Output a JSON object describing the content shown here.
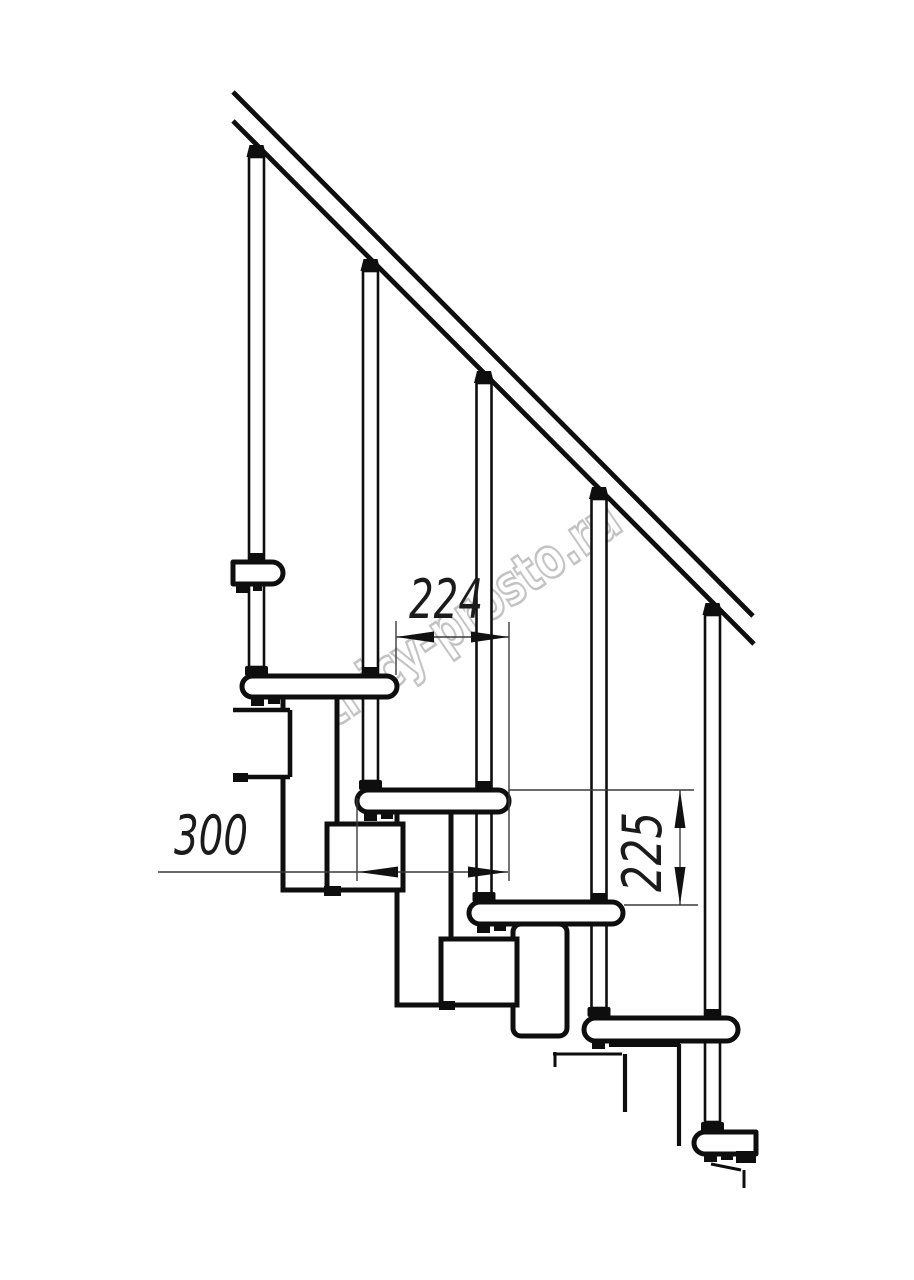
{
  "watermark": {
    "text": "lestnicy-prosto.ru",
    "stroke_color": "#c3c3c3",
    "fill_color": "#ffffff",
    "x": 452,
    "y": 648,
    "rotation": -34.5,
    "font_size": 56,
    "text_length": 420
  },
  "dimension_labels": [
    {
      "text": "224",
      "x": 446,
      "y": 618,
      "rotation": 0,
      "text_length": 74
    },
    {
      "text": "300",
      "x": 211,
      "y": 854,
      "rotation": 0,
      "text_length": 74
    },
    {
      "text": "225",
      "x": 661,
      "y": 852,
      "rotation": -90,
      "text_length": 80
    }
  ],
  "colors": {
    "background": "#ffffff",
    "line": "#0e0e0e",
    "dim_line": "#3a3a3a",
    "label_text": "#1b1b1b"
  },
  "geometry": {
    "rail": [
      [
        233,
        92,
        753,
        616
      ],
      [
        233,
        121,
        754,
        644
      ]
    ],
    "balusters": [
      [
        249,
        157,
        15,
        510
      ],
      [
        363,
        271,
        15,
        510
      ],
      [
        476.5,
        383,
        15,
        511
      ],
      [
        591.5,
        499,
        15,
        509
      ],
      [
        705,
        615,
        15,
        507
      ]
    ],
    "caps": [
      "249.5,145 263.5,145 266.5,157 246.5,157",
      "363.5,259 377.5,259 380.5,271 360.5,271",
      "477,371 491,371 494,383 474,383",
      "592,487 606,487 609,499 589,499",
      "705.5,603 719.5,603 722.5,615 702.5,615"
    ],
    "collars": [
      [
        248,
        553,
        17,
        9
      ],
      [
        362,
        667,
        17,
        9
      ],
      [
        475.5,
        781,
        17,
        9
      ],
      [
        590.5,
        893,
        17,
        9
      ],
      [
        704,
        1009,
        17,
        9
      ]
    ],
    "flanges": [
      [
        245,
        666,
        23,
        10
      ],
      [
        359,
        780,
        23,
        10
      ],
      [
        472.5,
        892,
        23,
        10
      ],
      [
        587.5,
        1007,
        23,
        10
      ],
      [
        701,
        1122,
        23,
        10
      ]
    ],
    "treads": [
      {
        "x": 233,
        "y": 562,
        "w": 50,
        "h": 22,
        "rl": 0,
        "rr": 1
      },
      {
        "x": 242,
        "y": 676,
        "w": 155,
        "h": 21,
        "rl": 1,
        "rr": 1
      },
      {
        "x": 357,
        "y": 790,
        "w": 152,
        "h": 22,
        "rl": 1,
        "rr": 1
      },
      {
        "x": 469,
        "y": 902,
        "w": 154,
        "h": 22,
        "rl": 1,
        "rr": 1
      },
      {
        "x": 584,
        "y": 1018,
        "w": 154,
        "h": 23,
        "rl": 1,
        "rr": 1
      },
      {
        "x": 694,
        "y": 1132,
        "w": 62,
        "h": 22,
        "rl": 1,
        "rr": 0
      }
    ],
    "modules": [
      [
        283,
        697,
        54,
        193,
        0
      ],
      [
        397,
        812,
        54,
        193,
        0
      ],
      [
        513,
        924,
        54,
        112,
        8
      ],
      [
        327,
        824,
        76,
        66,
        0
      ],
      [
        441,
        939,
        76,
        66,
        0
      ]
    ],
    "open_module_fill": [
      234,
      712,
      55,
      63
    ],
    "open_module_lines": [
      [
        233,
        710,
        290,
        710
      ],
      [
        290,
        710,
        290,
        777
      ],
      [
        233,
        777,
        290,
        777
      ]
    ],
    "feet": [
      [
        233,
        773,
        15,
        9
      ],
      [
        324,
        886,
        17,
        10
      ],
      [
        439,
        1001,
        16,
        9
      ]
    ],
    "wedges": [
      [
        236,
        584,
        13,
        9
      ],
      [
        253,
        584,
        9,
        7
      ],
      [
        251,
        697,
        13,
        9
      ],
      [
        268,
        697,
        12,
        7
      ],
      [
        364,
        812,
        13,
        9
      ],
      [
        381,
        812,
        12,
        7
      ],
      [
        477,
        924,
        13,
        9
      ],
      [
        494,
        924,
        12,
        7
      ],
      [
        592,
        1040,
        13,
        9
      ],
      [
        609,
        1040,
        12,
        7
      ],
      [
        704,
        1153,
        13,
        9
      ],
      [
        721,
        1153,
        12,
        7
      ],
      [
        736,
        1151,
        20,
        12
      ]
    ],
    "fragment_bar": [
      617,
      1041,
      63,
      6
    ],
    "fragments": [
      [
        555,
        1052,
        555,
        1067,
        3
      ],
      [
        553,
        1054,
        622,
        1054,
        3
      ],
      [
        625,
        1054,
        625,
        1112,
        4.2
      ],
      [
        679,
        1044,
        679,
        1146,
        4.2
      ],
      [
        711,
        1164,
        741,
        1170,
        3
      ],
      [
        744,
        1170,
        744,
        1188,
        3
      ]
    ],
    "dim_ext_lines": [
      [
        396,
        621,
        396,
        675
      ],
      [
        509,
        622,
        509,
        881
      ],
      [
        357,
        798,
        357,
        881
      ],
      [
        509,
        790,
        694,
        790
      ],
      [
        624,
        905,
        698,
        905
      ]
    ],
    "dim_lines": [
      [
        396,
        637,
        509,
        637
      ],
      [
        158,
        872,
        508,
        872
      ],
      [
        680,
        790,
        680,
        905
      ]
    ],
    "dim_arrows": [
      "396,637 434,631.5 434,642.5",
      "509,637 471,631.5 471,642.5",
      "358,872 398,866.5 398,877.5",
      "508,872 468,866.5 468,877.5",
      "680,790 674.5,828 685.5,828",
      "680,905 674.5,867 685.5,867"
    ]
  }
}
